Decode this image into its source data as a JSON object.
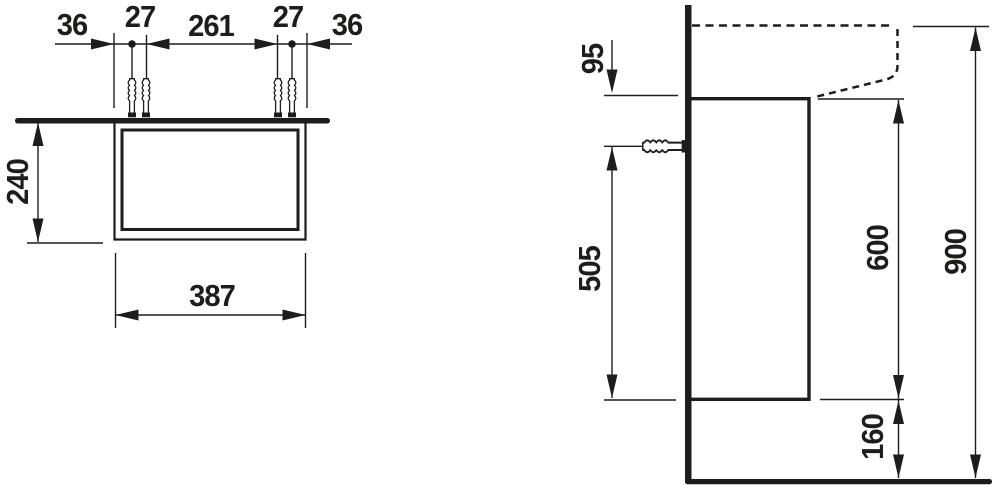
{
  "front_view": {
    "top_dimensions": [
      "36",
      "27",
      "261",
      "27",
      "36"
    ],
    "height": "240",
    "width": "387"
  },
  "side_view": {
    "basin_front_height": "95",
    "fixing_hole_height": "505",
    "cabinet_height": "600",
    "total_height": "900",
    "floor_clearance": "160"
  },
  "colors": {
    "line": "#1d1d1b",
    "background": "#ffffff"
  }
}
